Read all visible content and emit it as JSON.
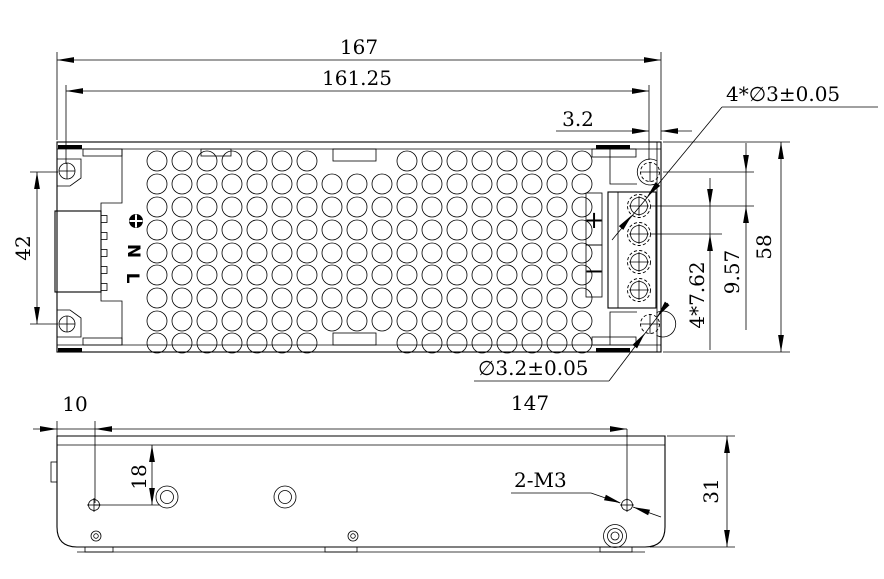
{
  "drawing": {
    "colors": {
      "line": "#000000",
      "background": "#ffffff",
      "text": "#000000"
    },
    "top_view": {
      "connector_labels": {
        "ground_icon": "ground-screw-icon",
        "neutral": "N",
        "line": "L"
      },
      "terminal_labels": {
        "plus": "+",
        "minus": "−"
      },
      "dimensions": {
        "overall_width": "167",
        "mounting_hole_span": "161.25",
        "hole_edge_offset": "3.2",
        "mounting_hole_vspan": "42",
        "overall_depth": "58",
        "hole_to_first_terminal": "9.57",
        "terminal_pitch": "4*7.62",
        "terminal_screw_dia": "4*∅3±0.05",
        "mounting_hole_dia": "∅3.2±0.05"
      }
    },
    "side_view": {
      "dimensions": {
        "screw_left_offset": "10",
        "screw_span": "147",
        "screw_top_offset": "18",
        "overall_height": "31",
        "screw_thread": "2-M3"
      }
    }
  }
}
